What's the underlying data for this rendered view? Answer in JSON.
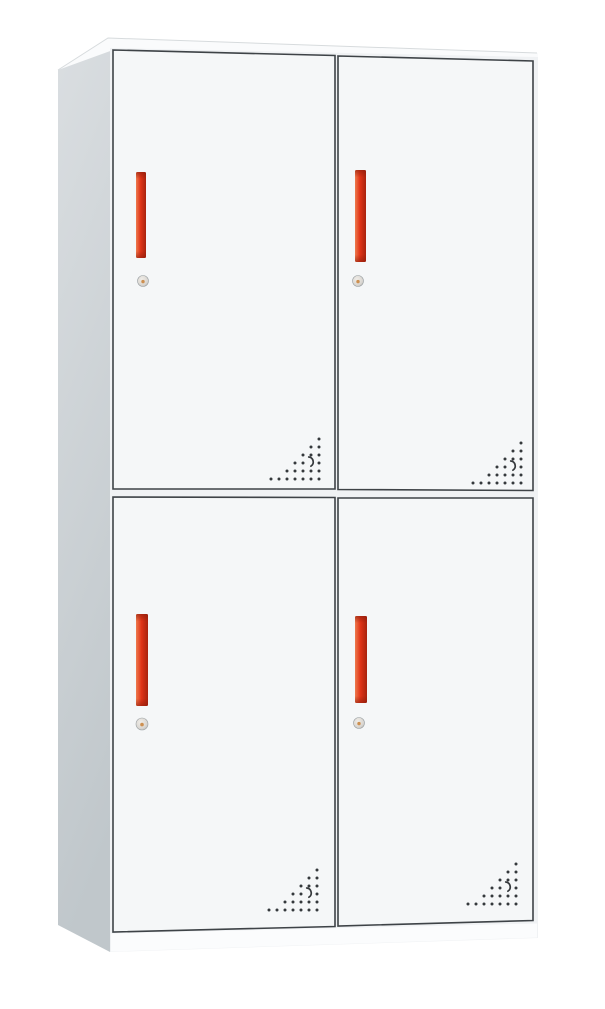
{
  "scene": {
    "type": "product-photo",
    "subject": "Four-door steel locker cabinet with red vertical handles, round cam locks and perforated vent patterns, viewed from the front-left in three-quarter perspective",
    "background_color": "#ffffff"
  },
  "colors": {
    "side_panel_top": "#dadee1",
    "side_panel_bottom": "#c0c7cb",
    "top_panel": "#fafbfc",
    "top_back_edge": "#d7dbdd",
    "front_frame": "#f0f2f4",
    "base_strip": "#fbfcfd",
    "door_face": "#f5f7f8",
    "door_edge": "#3e4347",
    "handle_highlight": "#ee7a4e",
    "handle_mid": "#e03417",
    "handle_shadow": "#a8230e",
    "handle_cap": "#8f1d0b",
    "lock_face": "#f0ede8",
    "lock_mid": "#d9d6d1",
    "lock_rim": "#b2b0ac",
    "lock_center": "#cd9051",
    "vent_hole": "#35393c"
  },
  "cabinet": {
    "door_count": 4,
    "layout": "2x2",
    "doors": [
      {
        "id": "top-left",
        "handle": "red vertical bar",
        "lock": "round cam lock",
        "vents": "triangular dot pattern at bottom-right corner"
      },
      {
        "id": "top-right",
        "handle": "red vertical bar",
        "lock": "round cam lock",
        "vents": "triangular dot pattern at bottom-right corner"
      },
      {
        "id": "bottom-left",
        "handle": "red vertical bar",
        "lock": "round cam lock",
        "vents": "triangular dot pattern at bottom-right corner"
      },
      {
        "id": "bottom-right",
        "handle": "red vertical bar",
        "lock": "round cam lock",
        "vents": "triangular dot pattern at bottom-right corner"
      }
    ]
  },
  "vents": {
    "pattern_rows": [
      1,
      2,
      3,
      4,
      5,
      7
    ],
    "spacing_px": 8,
    "dot_radius_px": 1.5,
    "crescent_slot": {
      "row_index": 3,
      "col_from_right": 1
    },
    "instances": [
      {
        "door": "top-left",
        "right_x": 319,
        "bottom_y": 479
      },
      {
        "door": "top-right",
        "right_x": 521,
        "bottom_y": 483
      },
      {
        "door": "bottom-left",
        "right_x": 317,
        "bottom_y": 910
      },
      {
        "door": "bottom-right",
        "right_x": 516,
        "bottom_y": 904
      }
    ]
  }
}
